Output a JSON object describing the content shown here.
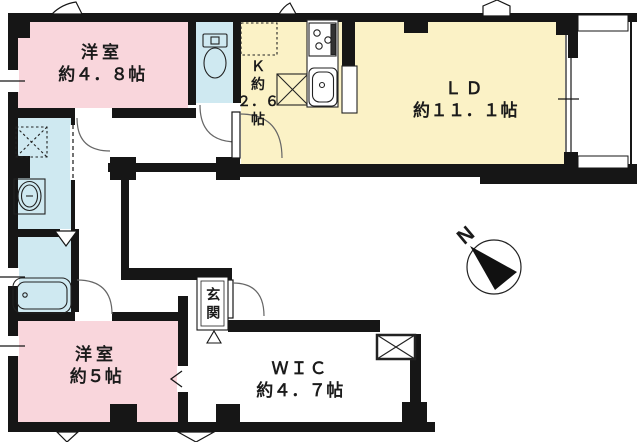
{
  "floor_plan": {
    "compass": {
      "label": "N"
    },
    "colors": {
      "wall": "#161616",
      "bedroom_fill": "#f9d6dc",
      "kitchen_living_fill": "#fbf2c6",
      "wet_area_fill": "#cfe9f1",
      "background": "#ffffff"
    },
    "rooms": {
      "bedroom1": {
        "name": "洋室",
        "size": "約４．８帖"
      },
      "bedroom2": {
        "name": "洋室",
        "size": "約５帖"
      },
      "kitchen": {
        "line1": "Ｋ",
        "line2": "約",
        "line3": "２．６",
        "line4": "帖"
      },
      "living_dining": {
        "name": "ＬＤ",
        "size": "約１１．１帖"
      },
      "wic": {
        "name": "ＷＩＣ",
        "size": "約４．７帖"
      },
      "entrance": {
        "name": "玄関"
      }
    },
    "fixtures": [
      "toilet-fixture",
      "bathtub-fixture",
      "washbasin-fixture",
      "washing-machine-space",
      "refrigerator-space",
      "stove-fixture",
      "kitchen-sink-fixture",
      "pipe-space-box",
      "compass-icon"
    ]
  }
}
